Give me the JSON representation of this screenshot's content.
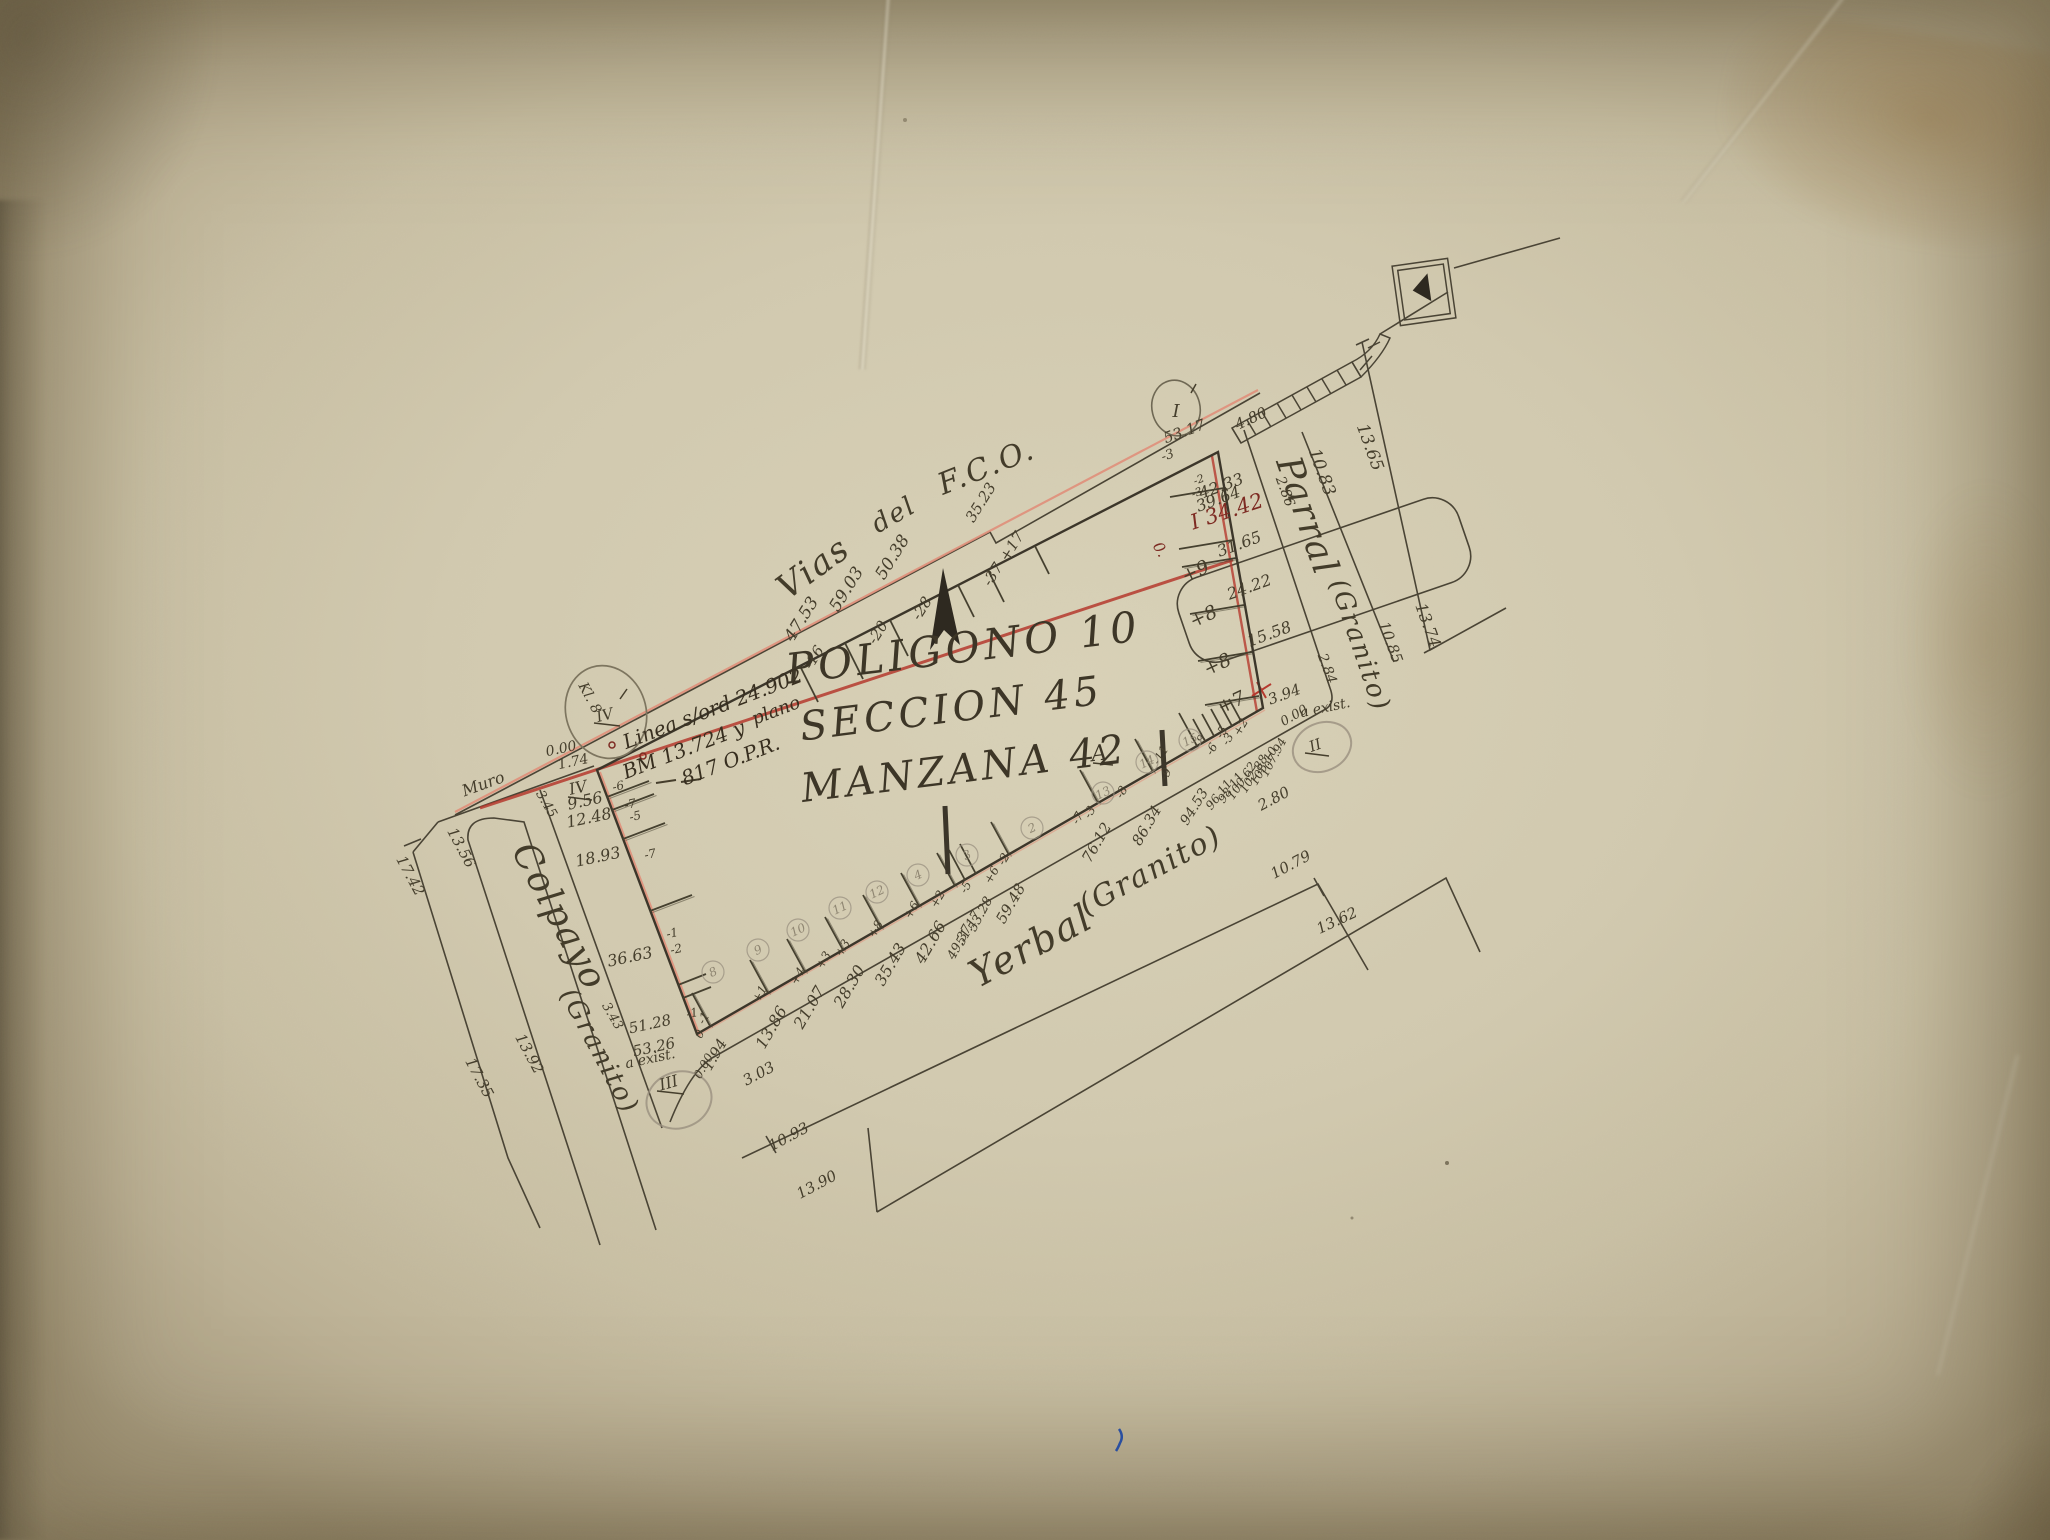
{
  "title": {
    "line1": "POLIGONO 10",
    "line2": "SECCION 45",
    "line3": "MANZANA 42",
    "sup": "A"
  },
  "streets": {
    "top": {
      "w1": "Vias",
      "w2": "del",
      "w3": "F.C.O."
    },
    "right": {
      "name": "Parral",
      "material": "(Granito)"
    },
    "bottom": {
      "name": "Yerbal",
      "material": "(Granito)"
    },
    "left": {
      "name": "Colpayo",
      "material": "(Granito)"
    }
  },
  "annotation": {
    "linea": "Linea s/ord 24.902",
    "bm": "BM 13.724 y",
    "plano": "plano",
    "opr": "817 O.P.R."
  },
  "corners": {
    "tr": "I",
    "br": "II",
    "bl": "III",
    "tl": "IV",
    "tl_circled": "IV"
  },
  "labels": [
    {
      "t": "47.53",
      "x": 806,
      "y": 622,
      "r": -58,
      "s": 17
    },
    {
      "t": "59.03",
      "x": 851,
      "y": 592,
      "r": -58,
      "s": 17
    },
    {
      "t": "50.38",
      "x": 897,
      "y": 560,
      "r": -58,
      "s": 17
    },
    {
      "t": "35.23",
      "x": 985,
      "y": 505,
      "r": -58,
      "s": 15
    },
    {
      "t": "+17",
      "x": 1016,
      "y": 549,
      "r": -58,
      "s": 15
    },
    {
      "t": "-37",
      "x": 997,
      "y": 577,
      "r": -58,
      "s": 15
    },
    {
      "t": "-28",
      "x": 926,
      "y": 611,
      "r": -58,
      "s": 15
    },
    {
      "t": "-20",
      "x": 882,
      "y": 635,
      "r": -58,
      "s": 15
    },
    {
      "t": "-16",
      "x": 818,
      "y": 660,
      "r": -58,
      "s": 15
    },
    {
      "t": "53.17",
      "x": 1186,
      "y": 436,
      "r": -20,
      "s": 15
    },
    {
      "t": "-3",
      "x": 1169,
      "y": 459,
      "r": -20,
      "s": 13
    },
    {
      "t": "4.80",
      "x": 1253,
      "y": 423,
      "r": -25,
      "s": 15
    },
    {
      "t": "I 34.42",
      "x": 1229,
      "y": 518,
      "r": -18,
      "s": 21,
      "c": "red2"
    },
    {
      "t": "0.",
      "x": 1156,
      "y": 552,
      "r": 60,
      "s": 15,
      "c": "red2"
    },
    {
      "t": "42.33",
      "x": 1223,
      "y": 491,
      "r": -20,
      "s": 16
    },
    {
      "t": "39.64",
      "x": 1220,
      "y": 504,
      "r": -20,
      "s": 16
    },
    {
      "t": "-2",
      "x": 1200,
      "y": 483,
      "r": -20,
      "s": 11
    },
    {
      "t": "-3",
      "x": 1198,
      "y": 496,
      "r": -20,
      "s": 11
    },
    {
      "t": "31.65",
      "x": 1241,
      "y": 549,
      "r": -20,
      "s": 16
    },
    {
      "t": "24.22",
      "x": 1251,
      "y": 592,
      "r": -20,
      "s": 16
    },
    {
      "t": "15.58",
      "x": 1271,
      "y": 639,
      "r": -20,
      "s": 16
    },
    {
      "t": "3.94",
      "x": 1286,
      "y": 699,
      "r": -20,
      "s": 15
    },
    {
      "t": "+9",
      "x": 1198,
      "y": 577,
      "r": -25,
      "s": 19
    },
    {
      "t": "+8",
      "x": 1206,
      "y": 622,
      "r": -25,
      "s": 19
    },
    {
      "t": "+8",
      "x": 1220,
      "y": 670,
      "r": -25,
      "s": 19
    },
    {
      "t": "+7",
      "x": 1234,
      "y": 708,
      "r": -25,
      "s": 19
    },
    {
      "t": "2.86",
      "x": 1281,
      "y": 493,
      "r": 70,
      "s": 14
    },
    {
      "t": "2.84",
      "x": 1323,
      "y": 670,
      "r": 70,
      "s": 14
    },
    {
      "t": "10.83",
      "x": 1317,
      "y": 474,
      "r": 70,
      "s": 17
    },
    {
      "t": "10.85",
      "x": 1386,
      "y": 644,
      "r": 70,
      "s": 15
    },
    {
      "t": "13.65",
      "x": 1365,
      "y": 449,
      "r": 70,
      "s": 17
    },
    {
      "t": "13.74",
      "x": 1423,
      "y": 627,
      "r": 70,
      "s": 16
    },
    {
      "t": "0.00",
      "x": 1296,
      "y": 719,
      "r": -30,
      "s": 13
    },
    {
      "t": "a exist.",
      "x": 1326,
      "y": 712,
      "r": -12,
      "s": 14
    },
    {
      "t": "2.80",
      "x": 1276,
      "y": 803,
      "r": -28,
      "s": 15
    },
    {
      "t": "94.53",
      "x": 1198,
      "y": 809,
      "r": -58,
      "s": 14
    },
    {
      "t": "96.11",
      "x": 1222,
      "y": 797,
      "r": -52,
      "s": 12
    },
    {
      "t": "98.11",
      "x": 1234,
      "y": 790,
      "r": -54,
      "s": 12
    },
    {
      "t": "100.62",
      "x": 1245,
      "y": 783,
      "r": -56,
      "s": 12
    },
    {
      "t": "102.88",
      "x": 1257,
      "y": 776,
      "r": -58,
      "s": 12
    },
    {
      "t": "105.10",
      "x": 1267,
      "y": 768,
      "r": -60,
      "s": 12
    },
    {
      "t": "107.94",
      "x": 1277,
      "y": 759,
      "r": -62,
      "s": 12
    },
    {
      "t": "1.94",
      "x": 719,
      "y": 1057,
      "r": -60,
      "s": 15
    },
    {
      "t": "13.86",
      "x": 776,
      "y": 1030,
      "r": -60,
      "s": 16
    },
    {
      "t": "21.07",
      "x": 814,
      "y": 1010,
      "r": -60,
      "s": 16
    },
    {
      "t": "28.30",
      "x": 854,
      "y": 989,
      "r": -60,
      "s": 16
    },
    {
      "t": "35.43",
      "x": 895,
      "y": 967,
      "r": -60,
      "s": 16
    },
    {
      "t": "42.66",
      "x": 935,
      "y": 945,
      "r": -60,
      "s": 16
    },
    {
      "t": "49.37",
      "x": 963,
      "y": 944,
      "r": -62,
      "s": 13
    },
    {
      "t": "51.17",
      "x": 972,
      "y": 930,
      "r": -62,
      "s": 13
    },
    {
      "t": "53.28",
      "x": 984,
      "y": 916,
      "r": -62,
      "s": 13
    },
    {
      "t": "59.48",
      "x": 1015,
      "y": 906,
      "r": -60,
      "s": 15
    },
    {
      "t": "76.12",
      "x": 1101,
      "y": 845,
      "r": -60,
      "s": 15
    },
    {
      "t": "86.34",
      "x": 1151,
      "y": 828,
      "r": -60,
      "s": 15
    },
    {
      "t": "3.03",
      "x": 761,
      "y": 1078,
      "r": -28,
      "s": 15
    },
    {
      "t": "0.00",
      "x": 707,
      "y": 1068,
      "r": -60,
      "s": 12
    },
    {
      "t": "0",
      "x": 703,
      "y": 1036,
      "r": -60,
      "s": 12
    },
    {
      "t": "a exist.",
      "x": 651,
      "y": 1063,
      "r": -12,
      "s": 14
    },
    {
      "t": "10.93",
      "x": 791,
      "y": 1141,
      "r": -28,
      "s": 15
    },
    {
      "t": "13.90",
      "x": 819,
      "y": 1189,
      "r": -28,
      "s": 15
    },
    {
      "t": "10.79",
      "x": 1293,
      "y": 869,
      "r": -28,
      "s": 15
    },
    {
      "t": "13.62",
      "x": 1339,
      "y": 925,
      "r": -25,
      "s": 15
    },
    {
      "t": "-1",
      "x": 707,
      "y": 1020,
      "r": -60,
      "s": 12
    },
    {
      "t": "+1",
      "x": 763,
      "y": 996,
      "r": -60,
      "s": 12
    },
    {
      "t": "+4",
      "x": 801,
      "y": 978,
      "r": -60,
      "s": 12
    },
    {
      "t": "+3",
      "x": 827,
      "y": 962,
      "r": -60,
      "s": 12
    },
    {
      "t": "+3",
      "x": 846,
      "y": 950,
      "r": -60,
      "s": 12
    },
    {
      "t": "+8",
      "x": 879,
      "y": 931,
      "r": -60,
      "s": 12
    },
    {
      "t": "+6",
      "x": 915,
      "y": 912,
      "r": -60,
      "s": 12
    },
    {
      "t": "+2",
      "x": 941,
      "y": 901,
      "r": -60,
      "s": 12
    },
    {
      "t": "-5",
      "x": 969,
      "y": 889,
      "r": -60,
      "s": 12
    },
    {
      "t": "+6",
      "x": 995,
      "y": 877,
      "r": -60,
      "s": 12
    },
    {
      "t": "-2",
      "x": 1007,
      "y": 861,
      "r": -60,
      "s": 12
    },
    {
      "t": "-7",
      "x": 1081,
      "y": 820,
      "r": -60,
      "s": 12
    },
    {
      "t": "-3",
      "x": 1093,
      "y": 814,
      "r": -60,
      "s": 12
    },
    {
      "t": "-8",
      "x": 1125,
      "y": 794,
      "r": -60,
      "s": 12
    },
    {
      "t": "-9",
      "x": 1169,
      "y": 776,
      "r": -60,
      "s": 12
    },
    {
      "t": "-11",
      "x": 1164,
      "y": 757,
      "r": -60,
      "s": 12
    },
    {
      "t": "-8",
      "x": 1204,
      "y": 743,
      "r": -60,
      "s": 12
    },
    {
      "t": "-6",
      "x": 1215,
      "y": 751,
      "r": -60,
      "s": 12
    },
    {
      "t": "-5",
      "x": 1225,
      "y": 734,
      "r": -60,
      "s": 12
    },
    {
      "t": "-3",
      "x": 1231,
      "y": 741,
      "r": -60,
      "s": 12
    },
    {
      "t": "+2",
      "x": 1244,
      "y": 729,
      "r": -60,
      "s": 12
    },
    {
      "t": "9.56",
      "x": 586,
      "y": 806,
      "r": -12,
      "s": 16
    },
    {
      "t": "12.48",
      "x": 590,
      "y": 823,
      "r": -12,
      "s": 16
    },
    {
      "t": "18.93",
      "x": 599,
      "y": 862,
      "r": -12,
      "s": 16
    },
    {
      "t": "36.63",
      "x": 631,
      "y": 962,
      "r": -12,
      "s": 16
    },
    {
      "t": "51.28",
      "x": 651,
      "y": 1029,
      "r": -12,
      "s": 15
    },
    {
      "t": "53.26",
      "x": 655,
      "y": 1052,
      "r": -12,
      "s": 15
    },
    {
      "t": "-6",
      "x": 619,
      "y": 790,
      "r": -12,
      "s": 12
    },
    {
      "t": "-7",
      "x": 631,
      "y": 808,
      "r": -12,
      "s": 12
    },
    {
      "t": "-5",
      "x": 636,
      "y": 820,
      "r": -12,
      "s": 12
    },
    {
      "t": "-7",
      "x": 651,
      "y": 858,
      "r": -12,
      "s": 12
    },
    {
      "t": "-1",
      "x": 673,
      "y": 937,
      "r": -12,
      "s": 12
    },
    {
      "t": "-2",
      "x": 677,
      "y": 953,
      "r": -12,
      "s": 12
    },
    {
      "t": "-1",
      "x": 693,
      "y": 1017,
      "r": -12,
      "s": 12
    },
    {
      "t": "0.00",
      "x": 562,
      "y": 753,
      "r": -12,
      "s": 14
    },
    {
      "t": "1.74",
      "x": 574,
      "y": 766,
      "r": -12,
      "s": 14
    },
    {
      "t": "Muro",
      "x": 485,
      "y": 789,
      "r": -20,
      "s": 16
    },
    {
      "t": "Kl. 8",
      "x": 586,
      "y": 700,
      "r": 62,
      "s": 14
    },
    {
      "t": "3.45",
      "x": 543,
      "y": 806,
      "r": 60,
      "s": 13
    },
    {
      "t": "3.43",
      "x": 609,
      "y": 1018,
      "r": 60,
      "s": 13
    },
    {
      "t": "13.56",
      "x": 457,
      "y": 850,
      "r": 62,
      "s": 15
    },
    {
      "t": "13.92",
      "x": 525,
      "y": 1056,
      "r": 62,
      "s": 15
    },
    {
      "t": "17.42",
      "x": 406,
      "y": 878,
      "r": 62,
      "s": 15
    },
    {
      "t": "17.35",
      "x": 475,
      "y": 1080,
      "r": 62,
      "s": 15
    }
  ],
  "lots": [
    {
      "n": "8",
      "x": 713,
      "y": 972
    },
    {
      "n": "9",
      "x": 758,
      "y": 950
    },
    {
      "n": "10",
      "x": 798,
      "y": 930
    },
    {
      "n": "11",
      "x": 840,
      "y": 908
    },
    {
      "n": "12",
      "x": 877,
      "y": 892
    },
    {
      "n": "4",
      "x": 918,
      "y": 875
    },
    {
      "n": "3",
      "x": 967,
      "y": 855
    },
    {
      "n": "2",
      "x": 1032,
      "y": 828
    },
    {
      "n": "13",
      "x": 1103,
      "y": 793
    },
    {
      "n": "14",
      "x": 1147,
      "y": 762
    },
    {
      "n": "15",
      "x": 1190,
      "y": 740
    }
  ]
}
